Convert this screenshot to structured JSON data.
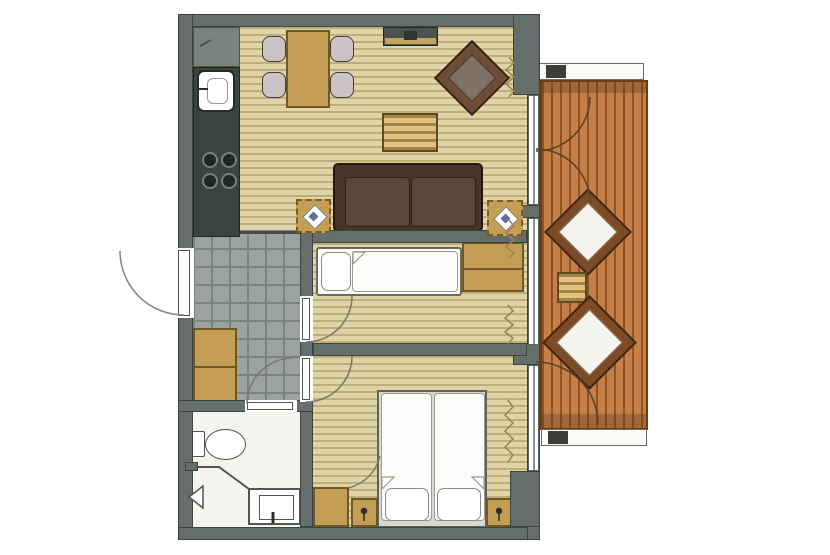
{
  "plan": {
    "kind": "apartment-floor-plan",
    "rooms": [
      {
        "id": "kitchen-dining-living",
        "floor": "wood-strip",
        "furniture": [
          "kitchen-counter",
          "refrigerator",
          "sink",
          "stove-4-burners",
          "dining-table",
          "dining-chair",
          "dining-chair",
          "dining-chair",
          "dining-chair",
          "tv-sideboard",
          "armchair",
          "coffee-table",
          "sofa",
          "floor-cushion",
          "floor-cushion",
          "curtain"
        ]
      },
      {
        "id": "hallway",
        "floor": "gray-tile",
        "furniture": [
          "wardrobe-cabinet",
          "entrance-door"
        ]
      },
      {
        "id": "children-room",
        "floor": "wood-strip",
        "furniture": [
          "single-bed",
          "pillow",
          "wardrobe",
          "door",
          "curtain"
        ]
      },
      {
        "id": "bedroom",
        "floor": "wood-strip",
        "furniture": [
          "double-bed",
          "pillow",
          "pillow",
          "nightstand",
          "nightstand",
          "table-lamp",
          "table-lamp",
          "wardrobe",
          "door",
          "curtain"
        ]
      },
      {
        "id": "bathroom",
        "floor": "white",
        "furniture": [
          "toilet",
          "shower-tray",
          "glass-partition",
          "door"
        ]
      },
      {
        "id": "balcony",
        "floor": "wood-deck",
        "furniture": [
          "lounge-chair",
          "lounge-chair",
          "side-table",
          "planter-box",
          "planter-box",
          "french-doors"
        ]
      }
    ]
  },
  "colors": {
    "wall": "#666e6b",
    "wall_outline": "#3d4543",
    "floor_wood_light": "#e0d4a6",
    "floor_wood_dark": "#bdaf7d",
    "floor_tile": "#9aa2a2",
    "floor_tile_line": "#7b8382",
    "bathroom_floor": "#f4f4f1",
    "counter": "#3b453f",
    "appliance_gray": "#7b837f",
    "furniture_tan": "#c49e54",
    "furniture_tan_dark": "#6d5826",
    "chair_gray": "#cbc2c5",
    "sofa_brown": "#483529",
    "sofa_cushion": "#5a463a",
    "armchair_frame": "#6f4c34",
    "armchair_seat": "#7d7168",
    "deck_light": "#c67f47",
    "deck_dark": "#8f5328",
    "deck_border": "#6b3d18",
    "lounge_frame": "#7c4c28",
    "accent_blue": "#5a6ea0",
    "line_gray": "#6f6f68",
    "curtain": "#97854e"
  }
}
